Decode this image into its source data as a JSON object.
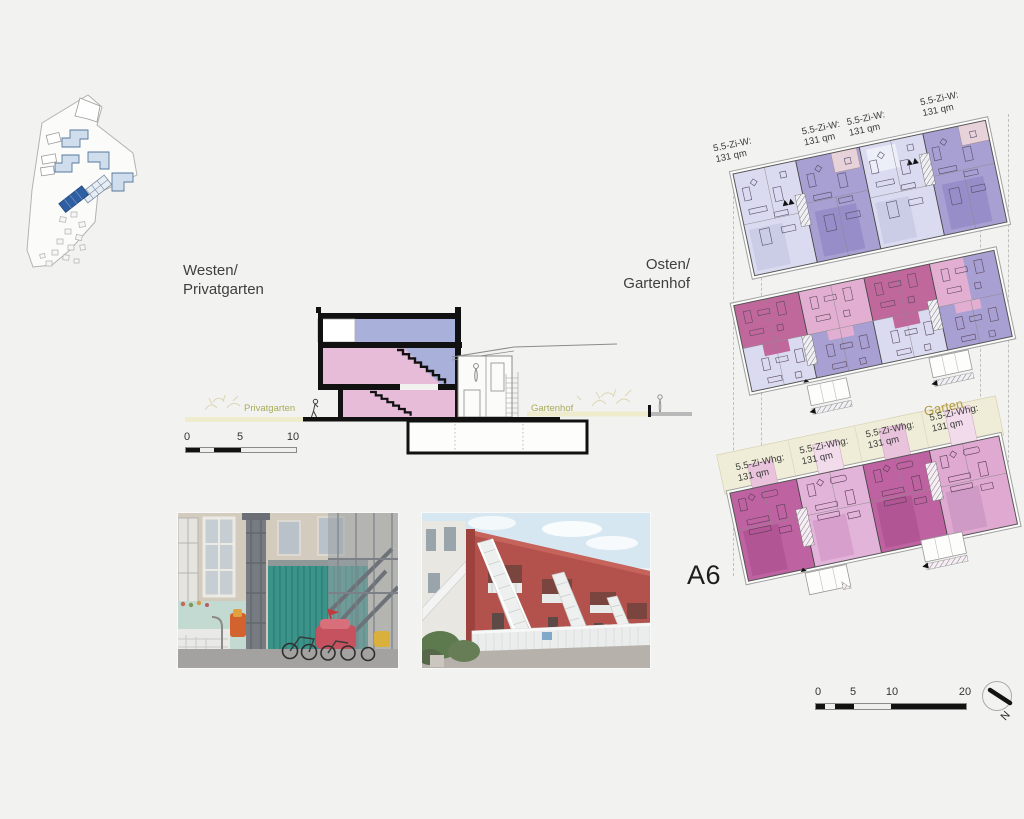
{
  "board": {
    "building_label": "A6",
    "background": "#f2f2f1"
  },
  "site_plan": {
    "highlight_color": "#2e5fa3",
    "building_color": "#cfdded"
  },
  "section": {
    "west_label": {
      "line1": "Westen/",
      "line2": "Privatgarten"
    },
    "east_label": {
      "line1": "Osten/",
      "line2": "Gartenhof"
    },
    "ground_labels": {
      "west": "Privatgarten",
      "east": "Gartenhof"
    },
    "scale_labels": [
      "0",
      "5",
      "10"
    ],
    "colors": {
      "upper_apartment": "#a9b0d9",
      "lower_apartment": "#e7bcd9",
      "garden_strip": "#eeeccd",
      "garden_text": "#a8ab5a"
    }
  },
  "floor_plans": {
    "upper_floor_labels": [
      {
        "line1": "5.5-Zi-W:",
        "line2": "131 qm"
      },
      {
        "line1": "5.5-Zi-W:",
        "line2": "131 qm"
      },
      {
        "line1": "5.5-Zi-W:",
        "line2": "131 qm"
      },
      {
        "line1": "5.5-Zi-W:",
        "line2": "131 qm"
      }
    ],
    "ground_floor_labels": [
      {
        "line1": "5.5-Zi-Whg:",
        "line2": "131 qm"
      },
      {
        "line1": "5.5-Zi-Whg:",
        "line2": "131 qm"
      },
      {
        "line1": "5.5-Zi-Whg:",
        "line2": "131 qm"
      },
      {
        "line1": "5.5-Zi-Whg:",
        "line2": "131 qm"
      }
    ],
    "garden_label": "Garten",
    "colors": {
      "lavender_light": "#dadbf0",
      "purple": "#a89fd3",
      "magenta_dark": "#c0679c",
      "pink_light": "#e2afd2",
      "eg_magenta": "#bf62a2",
      "eg_pink": "#e3b4da",
      "terrace_pink": "#e8d2da",
      "garden_beige": "#efecd7"
    }
  },
  "scale_bar": {
    "labels": [
      "0",
      "5",
      "10",
      "20"
    ],
    "north_label": "N"
  }
}
